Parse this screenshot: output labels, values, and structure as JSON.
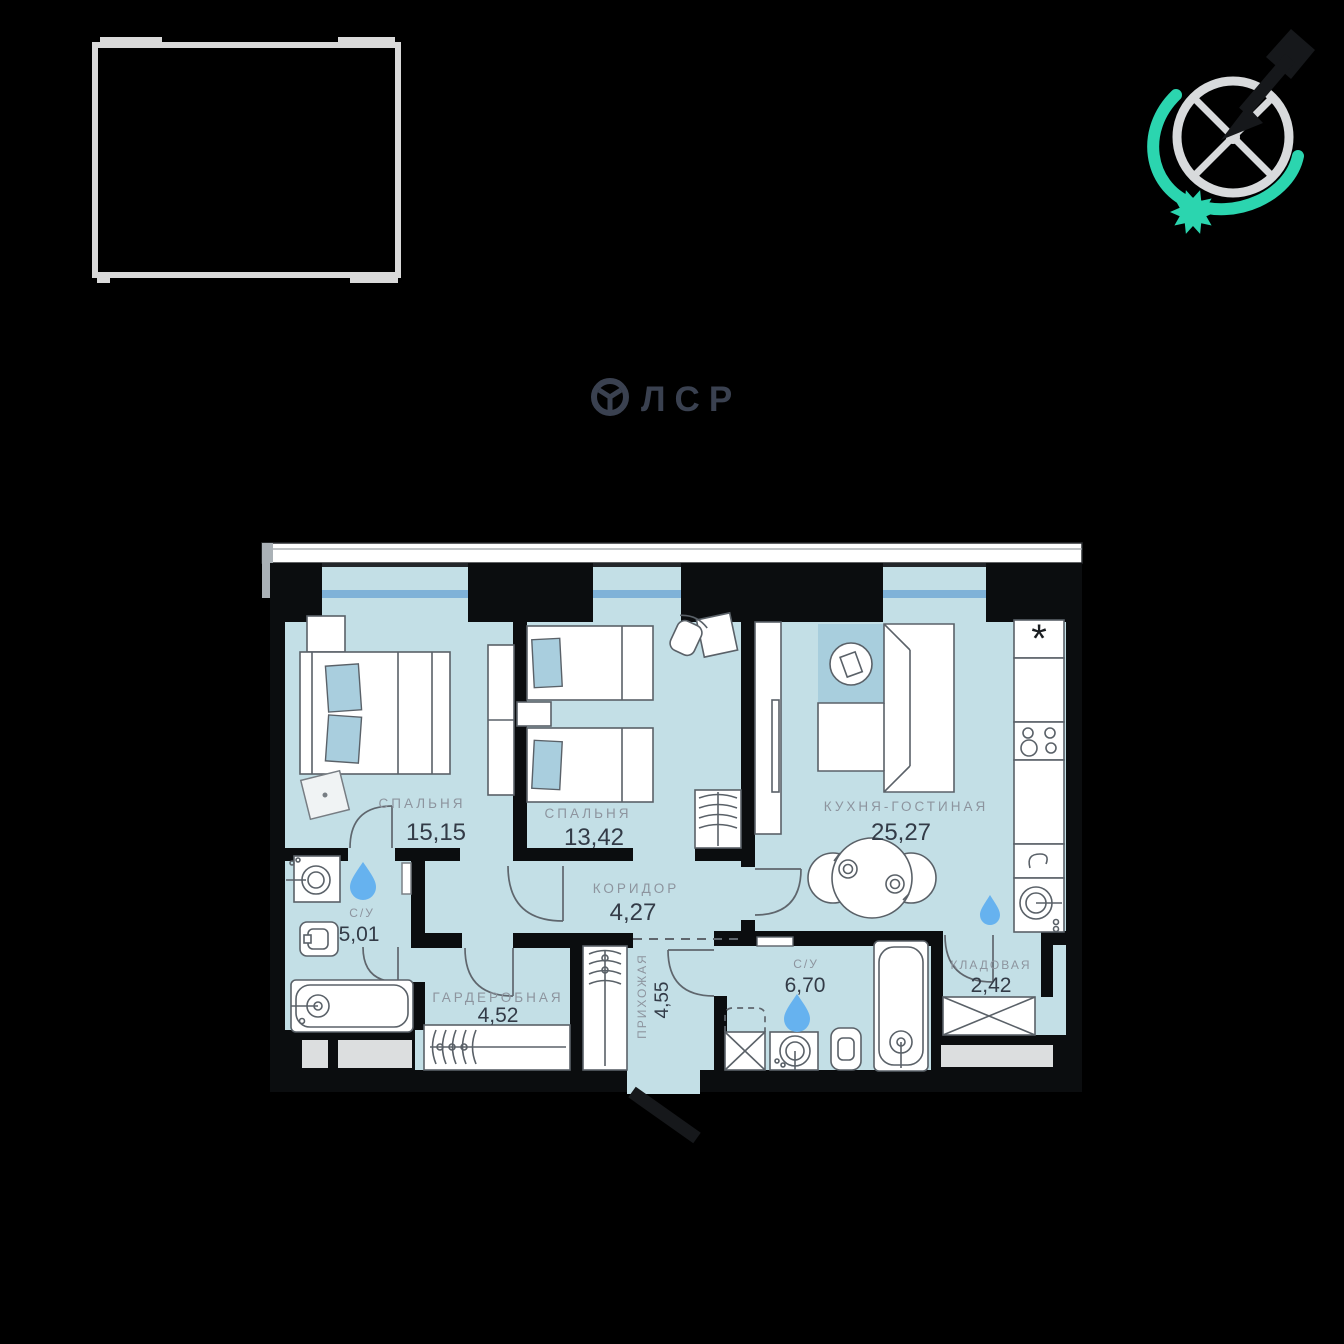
{
  "brand": {
    "logo_text": "ЛСР"
  },
  "rooms": {
    "bedroom1": {
      "name": "СПАЛЬНЯ",
      "area": "15,15"
    },
    "bedroom2": {
      "name": "СПАЛЬНЯ",
      "area": "13,42"
    },
    "kitchen_living": {
      "name": "КУХНЯ-ГОСТИНАЯ",
      "area": "25,27"
    },
    "corridor": {
      "name": "КОРИДОР",
      "area": "4,27"
    },
    "bathroom1": {
      "name": "С/У",
      "area": "5,01"
    },
    "wardrobe_room": {
      "name": "ГАРДЕРОБНАЯ",
      "area": "4,52"
    },
    "hallway": {
      "name": "ПРИХОЖАЯ",
      "area": "4,55"
    },
    "bathroom2": {
      "name": "С/У",
      "area": "6,70"
    },
    "storage": {
      "name": "КЛАДОВАЯ",
      "area": "2,42"
    }
  },
  "symbols": {
    "fridge": "*"
  },
  "colors": {
    "background": "#000000",
    "floor": "#c3dfe6",
    "rug": "#a8cedd",
    "wall": "#0b0d0f",
    "window_glass": "#7fb2d8",
    "water_drop": "#66b2ef",
    "accent_teal": "#2bd5af",
    "label_gray": "#8d949e",
    "number_dark": "#333b47",
    "logo_navy": "#3a4150",
    "frame_gray": "#d9d9d9"
  }
}
